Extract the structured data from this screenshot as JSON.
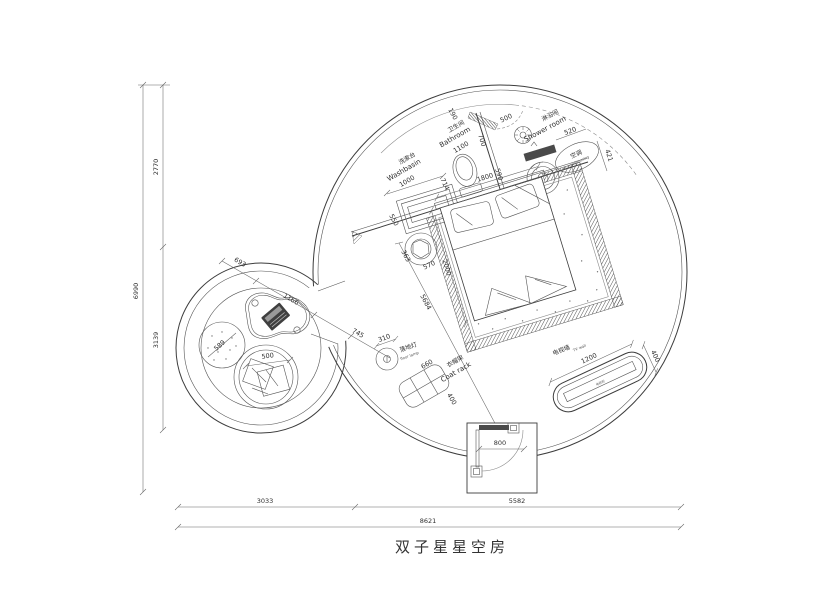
{
  "title": "双子星星空房",
  "dims": {
    "total_height": "6990",
    "upper_height": "2770",
    "lower_height": "3139",
    "left_width": "3033",
    "right_width": "5582",
    "total_width": "8621",
    "door": "800",
    "bed_w": "1800",
    "bed_l": "2000",
    "diag": "5684",
    "top": "190",
    "bath_side": "700",
    "bath_door": "500",
    "bath_inner": "590",
    "toilet": "714",
    "basin": "1000",
    "counter_depth": "550",
    "sink_w": "363",
    "sink_d": "570",
    "bench": "520",
    "ac": "421",
    "lamp": "310",
    "rack_w": "660",
    "rack_d": "400",
    "tv_w": "1200",
    "tv_d": "400",
    "lounge_a": "693",
    "table": "1166",
    "lounge_b": "745",
    "pouf": "589",
    "chair": "500"
  },
  "labels": {
    "washbasin_cn": "洗漱台",
    "washbasin_en": "Washbasin",
    "bathroom_cn": "卫生间",
    "bathroom_en": "Bathroom",
    "shower_cn": "淋浴间",
    "shower_en": "Shower room",
    "ac_cn": "空调",
    "ac_en": "air-conditioning",
    "lamp_cn": "落地灯",
    "lamp_en": "floor lamp",
    "rack_cn": "衣帽架",
    "rack_en": "Coat rack",
    "tv_cn": "电视墙",
    "tv_en": "TV wall",
    "tv_cabinet": "电视柜"
  }
}
